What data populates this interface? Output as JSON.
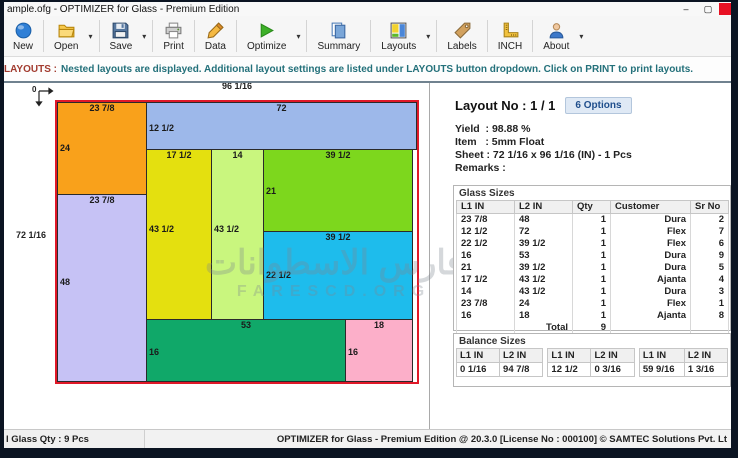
{
  "window": {
    "title": "ample.ofg - OPTIMIZER for Glass - Premium Edition",
    "minimize": "–",
    "maximize": "▢"
  },
  "toolbar": {
    "buttons": [
      {
        "label": "New",
        "icon": "new-icon",
        "dropdown": false
      },
      {
        "label": "Open",
        "icon": "open-folder-icon",
        "dropdown": true
      },
      {
        "label": "Save",
        "icon": "save-floppy-icon",
        "dropdown": true
      },
      {
        "label": "Print",
        "icon": "printer-icon",
        "dropdown": false
      },
      {
        "label": "Data",
        "icon": "pencil-icon",
        "dropdown": false
      },
      {
        "label": "Optimize",
        "icon": "play-icon",
        "dropdown": true
      },
      {
        "label": "Summary",
        "icon": "document-icon",
        "dropdown": false
      },
      {
        "label": "Layouts",
        "icon": "layout-grid-icon",
        "dropdown": true
      },
      {
        "label": "Labels",
        "icon": "tag-icon",
        "dropdown": false
      },
      {
        "label": "INCH",
        "icon": "ruler-icon",
        "dropdown": false
      },
      {
        "label": "About",
        "icon": "person-icon",
        "dropdown": true
      }
    ],
    "dropdown_glyph": "▾"
  },
  "notice": {
    "prefix": "LAYOUTS :",
    "body": "Nested layouts are displayed. Additional layout settings are listed under LAYOUTS button dropdown. Click on PRINT to print layouts."
  },
  "layout_panel": {
    "title": "Layout No : 1 / 1",
    "options_button": "6 Options",
    "yield": "Yield  : 98.88 %",
    "item": "Item   : 5mm Float",
    "sheet": "Sheet : 72 1/16 x 96 1/16 (IN) - 1 Pcs",
    "remarks": "Remarks :"
  },
  "diagram": {
    "sheet_width_label": "96 1/16",
    "sheet_height_label": "72 1/16",
    "origin_label": "0",
    "sheet_border_color": "#e01828",
    "pieces": [
      {
        "name": "piece-orange",
        "color": "#F9A11B",
        "w_label": "23 7/8",
        "h_label": "24"
      },
      {
        "name": "piece-blue",
        "color": "#9DB8EA",
        "w_label": "72",
        "h_label": "12 1/2"
      },
      {
        "name": "piece-yellow",
        "color": "#E4E00F",
        "w_label": "17 1/2",
        "h_label": "43 1/2"
      },
      {
        "name": "piece-pale-green",
        "color": "#C9F67E",
        "w_label": "14",
        "h_label": "43 1/2"
      },
      {
        "name": "piece-green",
        "color": "#7DD71D",
        "w_label": "39 1/2",
        "h_label": "21"
      },
      {
        "name": "piece-cyan",
        "color": "#1EBCEC",
        "w_label": "39 1/2",
        "h_label": "22 1/2"
      },
      {
        "name": "piece-lavender",
        "color": "#C6C2F5",
        "w_label": "23 7/8",
        "h_label": "48"
      },
      {
        "name": "piece-sea-green",
        "color": "#10A869",
        "w_label": "53",
        "h_label": "16"
      },
      {
        "name": "piece-pink",
        "color": "#FCAFC9",
        "w_label": "18",
        "h_label": "16"
      }
    ]
  },
  "glass_sizes": {
    "title": "Glass Sizes",
    "columns": [
      "L1 IN",
      "L2 IN",
      "Qty",
      "Customer",
      "Sr No"
    ],
    "rows": [
      [
        "23 7/8",
        "48",
        "1",
        "Dura",
        "2"
      ],
      [
        "12 1/2",
        "72",
        "1",
        "Flex",
        "7"
      ],
      [
        "22 1/2",
        "39 1/2",
        "1",
        "Flex",
        "6"
      ],
      [
        "16",
        "53",
        "1",
        "Dura",
        "9"
      ],
      [
        "21",
        "39 1/2",
        "1",
        "Dura",
        "5"
      ],
      [
        "17 1/2",
        "43 1/2",
        "1",
        "Ajanta",
        "4"
      ],
      [
        "14",
        "43 1/2",
        "1",
        "Dura",
        "3"
      ],
      [
        "23 7/8",
        "24",
        "1",
        "Flex",
        "1"
      ],
      [
        "16",
        "18",
        "1",
        "Ajanta",
        "8"
      ]
    ],
    "total_label": "Total",
    "total_qty": "9"
  },
  "balance_sizes": {
    "title": "Balance Sizes",
    "columns": [
      "L1 IN",
      "L2 IN",
      "L1 IN",
      "L2 IN",
      "L1 IN",
      "L2 IN"
    ],
    "values": [
      "0 1/16",
      "94 7/8",
      "12 1/2",
      "0 3/16",
      "59 9/16",
      "1 3/16"
    ]
  },
  "status_bar": {
    "left": "l Glass Qty : 9 Pcs",
    "right": "OPTIMIZER for Glass - Premium Edition @ 20.3.0 [License No : 000100] © SAMTEC Solutions Pvt. Lt"
  },
  "watermark": {
    "line1": "فارس الاسطوانات",
    "line2": "FARESCD.ORG"
  }
}
